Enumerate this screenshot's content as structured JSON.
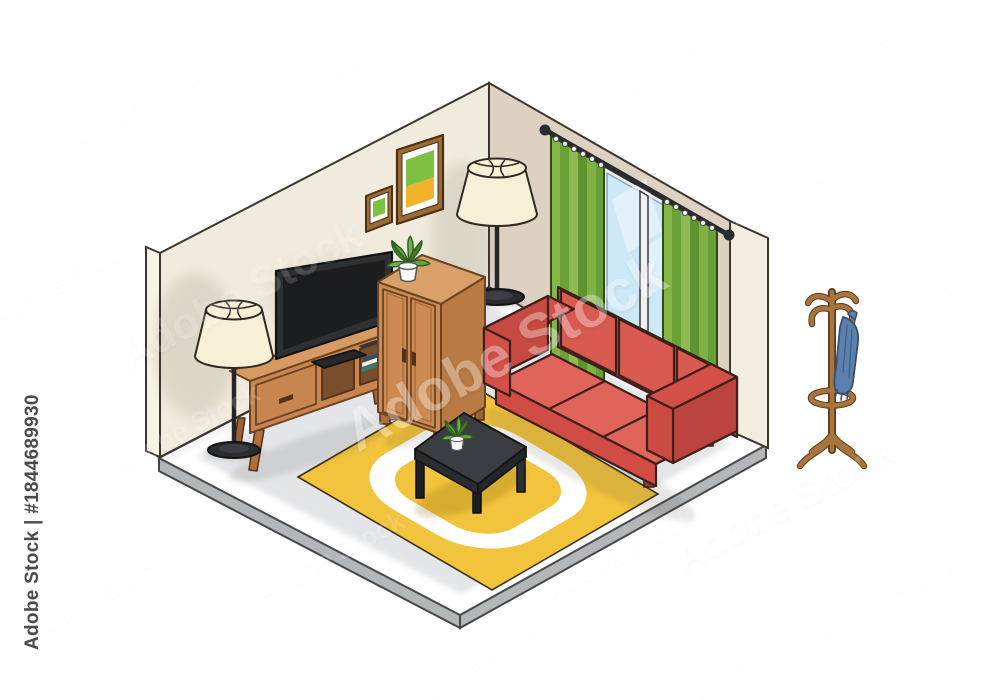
{
  "artwork": {
    "type": "isometric vector illustration",
    "subject": "Living room interior with sofa, TV, cabinet, lamps, window with curtains, rug, coffee table and coat rack",
    "background_color": "#ffffff"
  },
  "watermark": {
    "brand": "Adobe Stock",
    "asset_id": "#1844689930",
    "sidebar_text": "Adobe Stock | #1844689930",
    "tile_text": "Adobe Stock",
    "tile_color": "#ffffff",
    "sidebar_text_color": "#4b4b4b"
  },
  "scene": {
    "room": {
      "left_wall_color": "#f1ebdd",
      "right_wall_color": "#ddd2c2",
      "wall_edge_color": "#f7f2e6",
      "floor_color": "#e4e5e8",
      "floor_margin_color": "#ffffff",
      "floor_side_color": "#b4b7ba"
    },
    "objects": [
      {
        "name": "picture-frame-large",
        "colors": {
          "frame": "#9c6b38",
          "mat": "#fdfdfc",
          "art_top": "#7cc142",
          "art_bottom": "#f2b32a"
        }
      },
      {
        "name": "picture-frame-small",
        "colors": {
          "frame": "#9c6b38",
          "mat": "#fdfdfc",
          "art": "#7cc142"
        }
      },
      {
        "name": "tv",
        "colors": {
          "bezel": "#2e3033",
          "screen": "#1b1d1f"
        }
      },
      {
        "name": "tv-stand",
        "colors": {
          "wood": "#c9854f",
          "wood_top": "#d79a62",
          "wood_dark": "#b0703c",
          "books": [
            "#2e7f74",
            "#f2f2f2",
            "#28506b"
          ]
        }
      },
      {
        "name": "cabinet",
        "colors": {
          "wood": "#cd8a52",
          "wood_top": "#daa06a",
          "wood_side": "#b97a44"
        }
      },
      {
        "name": "floor-lamp-left",
        "colors": {
          "shade": "#f8efd7",
          "pole": "#26262a",
          "base": "#2b2c30"
        }
      },
      {
        "name": "floor-lamp-corner",
        "colors": {
          "shade": "#f8efd7",
          "pole": "#26262a",
          "base": "#2b2c30"
        }
      },
      {
        "name": "window",
        "colors": {
          "frame": "#eef0f2",
          "glass": "#cde8f6"
        }
      },
      {
        "name": "curtains",
        "colors": {
          "green": "#7fae42",
          "rod": "#2a2b2e"
        }
      },
      {
        "name": "sofa",
        "colors": {
          "body": "#cc4a42",
          "back": "#c24840",
          "cushions": "#e0645a",
          "legs": "#7b4a28"
        }
      },
      {
        "name": "rug",
        "colors": {
          "base": "#f2c33c",
          "ring": "#ffffff"
        }
      },
      {
        "name": "coffee-table",
        "colors": {
          "top": "#3a3e42",
          "legs": "#1d1f21"
        }
      },
      {
        "name": "plant",
        "colors": {
          "leaves": "#5fa43c",
          "pot": "#fafafa"
        }
      },
      {
        "name": "coat-rack",
        "colors": {
          "wood": "#a9753e",
          "garment": "#5b80ae"
        }
      }
    ]
  }
}
